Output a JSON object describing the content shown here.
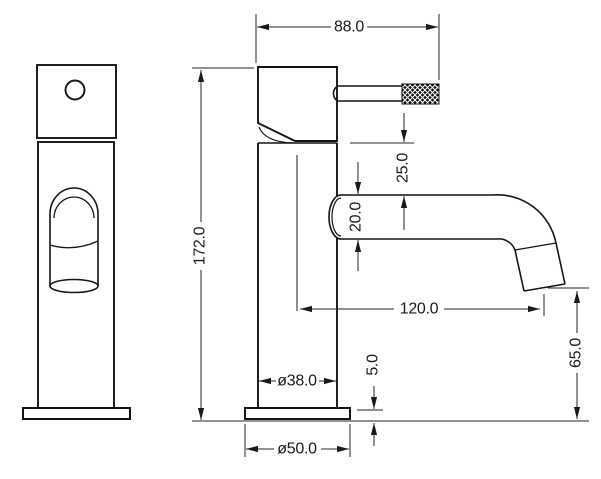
{
  "drawing": {
    "type": "technical-drawing",
    "subject": "basin mixer tap",
    "colors": {
      "line": "#141414",
      "dimension_line": "#242424",
      "background": "#ffffff"
    },
    "dimensions": {
      "overall_width": {
        "label": "88.0",
        "value": 88.0
      },
      "overall_height": {
        "label": "172.0",
        "value": 172.0
      },
      "head_to_spout_drop": {
        "label": "25.0",
        "value": 25.0
      },
      "spout_tube_diameter": {
        "label": "20.0",
        "value": 20.0
      },
      "spout_reach": {
        "label": "120.0",
        "value": 120.0
      },
      "outlet_clearance": {
        "label": "65.0",
        "value": 65.0
      },
      "base_plate_height": {
        "label": "5.0",
        "value": 5.0
      },
      "body_diameter": {
        "label": "ø38.0",
        "value": 38.0
      },
      "base_diameter": {
        "label": "ø50.0",
        "value": 50.0
      }
    }
  }
}
